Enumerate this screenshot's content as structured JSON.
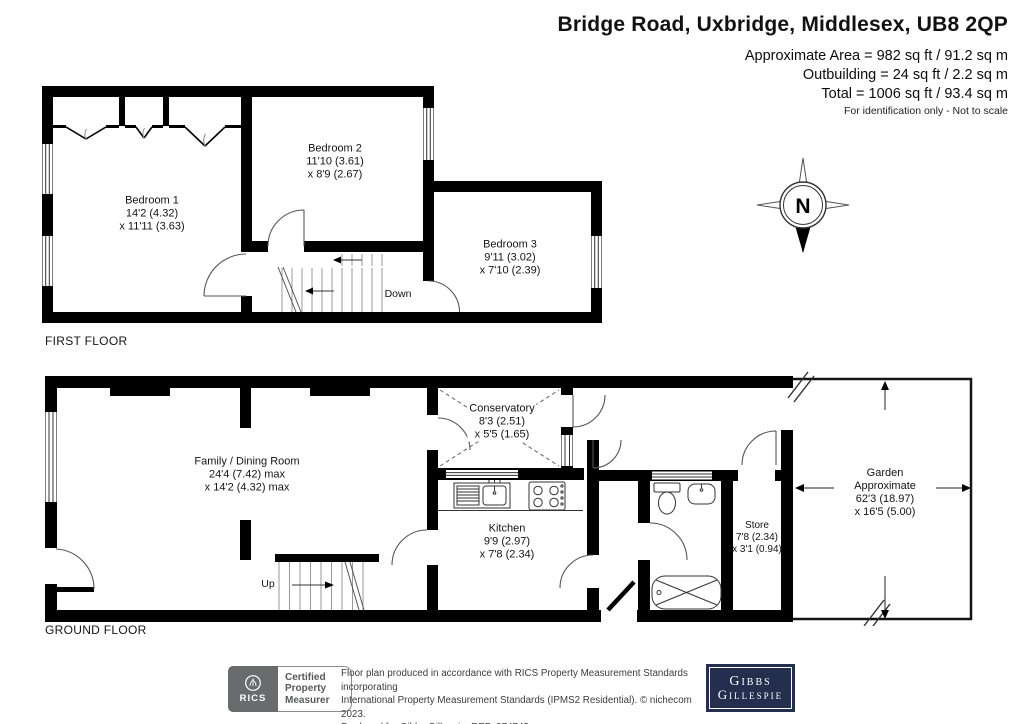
{
  "header": {
    "title": "Bridge Road, Uxbridge, Middlesex, UB8 2QP",
    "area_line1": "Approximate Area = 982 sq ft / 91.2 sq m",
    "area_line2": "Outbuilding = 24 sq ft / 2.2 sq m",
    "area_line3": "Total = 1006 sq ft / 93.4 sq m",
    "note": "For identification only - Not to scale"
  },
  "compass": {
    "label": "N"
  },
  "first_floor": {
    "caption": "FIRST FLOOR",
    "stair_label": "Down",
    "rooms": {
      "bedroom1": {
        "name": "Bedroom 1",
        "d1": "14'2 (4.32)",
        "d2": "x 11'11 (3.63)"
      },
      "bedroom2": {
        "name": "Bedroom 2",
        "d1": "11'10 (3.61)",
        "d2": "x 8'9 (2.67)"
      },
      "bedroom3": {
        "name": "Bedroom 3",
        "d1": "9'11 (3.02)",
        "d2": "x 7'10 (2.39)"
      }
    }
  },
  "ground_floor": {
    "caption": "GROUND FLOOR",
    "stair_label": "Up",
    "rooms": {
      "family": {
        "name": "Family / Dining Room",
        "d1": "24'4 (7.42) max",
        "d2": "x 14'2 (4.32) max"
      },
      "conservatory": {
        "name": "Conservatory",
        "d1": "8'3 (2.51)",
        "d2": "x 5'5 (1.65)"
      },
      "kitchen": {
        "name": "Kitchen",
        "d1": "9'9 (2.97)",
        "d2": "x 7'8 (2.34)"
      },
      "store": {
        "name": "Store",
        "d1": "7'8 (2.34)",
        "d2": "x 3'1 (0.94)"
      },
      "garden": {
        "name": "Garden",
        "d1": "Approximate",
        "d2": "62'3 (18.97)",
        "d3": "x 16'5 (5.00)"
      }
    }
  },
  "footer": {
    "rics_label": "RICS",
    "badge": {
      "line1": "Certified",
      "line2": "Property",
      "line3": "Measurer"
    },
    "disclaimer_line1": "Floor plan produced in accordance with RICS Property Measurement Standards incorporating",
    "disclaimer_line2": "International Property Measurement Standards (IPMS2 Residential).  © nichecom 2023.",
    "disclaimer_line3": "Produced for Gibbs Gillespie.  REF: 974743",
    "logo": {
      "line1": "Gibbs",
      "line2": "Gillespie"
    }
  },
  "colors": {
    "wall": "#000000",
    "logo_navy": "#242e4e",
    "rics_gray": "#6a6b6d"
  }
}
